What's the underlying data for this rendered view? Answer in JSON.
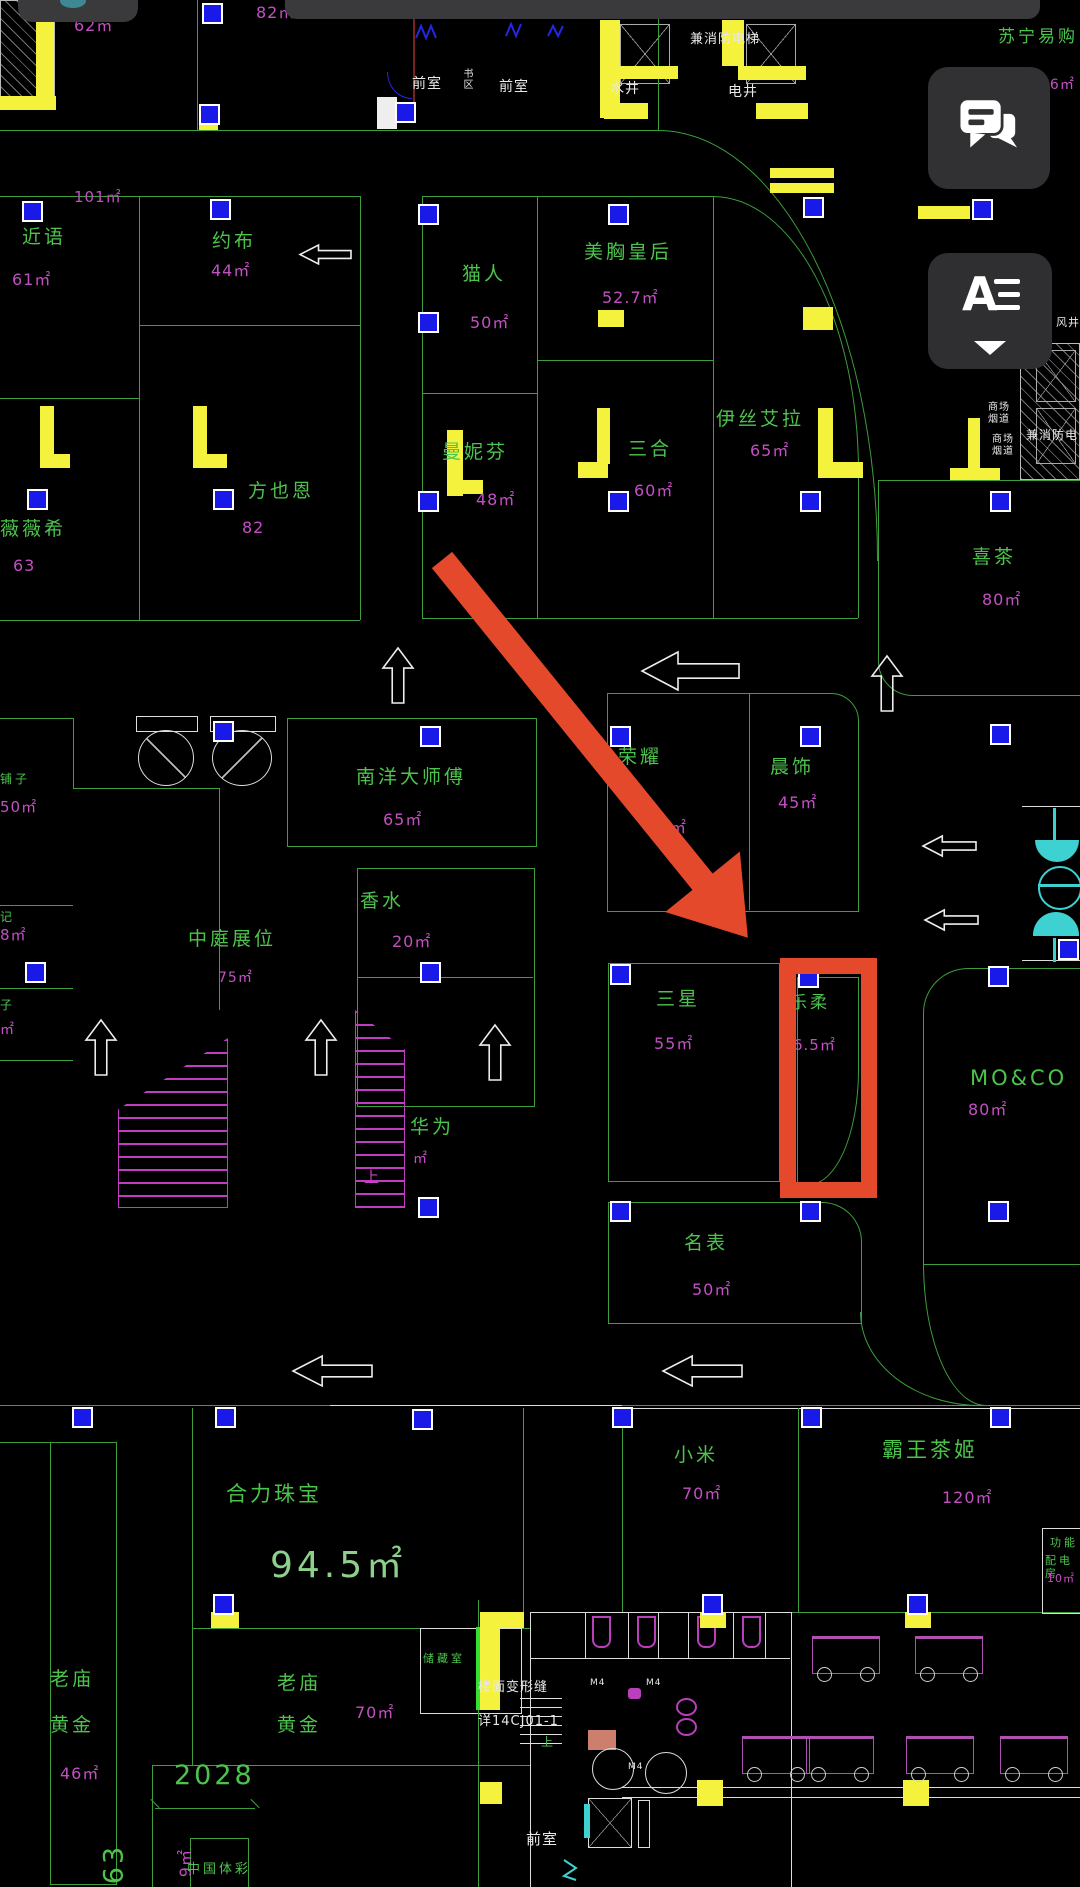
{
  "ui": {
    "statusbar": {
      "camera_color": "#3E8894"
    },
    "chat_button": {
      "icon": "chat-bubbles-icon"
    },
    "layer_button": {
      "label": "A",
      "icon": "text-layers-icon",
      "caret": "caret-down"
    }
  },
  "annotation": {
    "color": "#E5492B",
    "arrow": {
      "x": 442,
      "y": 560,
      "length": 486,
      "angle_deg": 51,
      "shaft_px": 26,
      "head_len": 72,
      "head_w": 96
    },
    "highlight_rect": {
      "x": 780,
      "y": 958,
      "w": 97,
      "h": 240,
      "border_px": 16
    }
  },
  "palette": {
    "line_green": "#3C9F3C",
    "text_green": "#4CC44C",
    "area_magenta": "#C250C2",
    "big_green": "#8CD08C",
    "white": "#E8E8E8",
    "yellow": "#F5F23D",
    "marker_blue": "#1A1AE8",
    "cyan": "#3ED1D1",
    "red": "#E5492B",
    "panel": "#313134"
  },
  "plan": {
    "labels": [
      {
        "n": "area-62",
        "t": "62㎡",
        "x": 74,
        "y": 16,
        "c": "area"
      },
      {
        "n": "area-82",
        "t": "82㎡",
        "x": 256,
        "y": 3,
        "c": "area"
      },
      {
        "n": "room-front-1",
        "t": "前室",
        "x": 412,
        "y": 76,
        "c": "white"
      },
      {
        "n": "room-shuqu",
        "t": "书区",
        "x": 460,
        "y": 68,
        "c": "white",
        "s": 10,
        "v": 1
      },
      {
        "n": "room-front-2",
        "t": "前室",
        "x": 499,
        "y": 79,
        "c": "white"
      },
      {
        "n": "room-water-shaft",
        "t": "水井",
        "x": 610,
        "y": 81,
        "c": "white"
      },
      {
        "n": "note-fire-elevator-top",
        "t": "兼消防电梯",
        "x": 690,
        "y": 32,
        "c": "white",
        "s": 13
      },
      {
        "n": "room-elec-shaft",
        "t": "电井",
        "x": 728,
        "y": 84,
        "c": "white"
      },
      {
        "n": "store-suning",
        "t": "苏宁易购",
        "x": 998,
        "y": 27,
        "c": "store",
        "s": 17
      },
      {
        "n": "area-suning",
        "t": "26㎡",
        "x": 1040,
        "y": 77,
        "c": "area",
        "s": 14
      },
      {
        "n": "area-101",
        "t": "101㎡",
        "x": 74,
        "y": 188,
        "c": "area",
        "s": 15
      },
      {
        "n": "store-jinyu",
        "t": "近语",
        "x": 22,
        "y": 226,
        "c": "store"
      },
      {
        "n": "area-jinyu",
        "t": "61㎡",
        "x": 12,
        "y": 270,
        "c": "area"
      },
      {
        "n": "store-yuebu",
        "t": "约布",
        "x": 212,
        "y": 230,
        "c": "store"
      },
      {
        "n": "area-yuebu",
        "t": "44㎡",
        "x": 211,
        "y": 261,
        "c": "area"
      },
      {
        "n": "store-weiweixi",
        "t": "薇薇希",
        "x": 0,
        "y": 518,
        "c": "store"
      },
      {
        "n": "area-weiweixi",
        "t": "63",
        "x": 13,
        "y": 556,
        "c": "area"
      },
      {
        "n": "store-fangyeen",
        "t": "方也恩",
        "x": 248,
        "y": 480,
        "c": "store"
      },
      {
        "n": "area-fangyeen",
        "t": "82",
        "x": 242,
        "y": 518,
        "c": "area"
      },
      {
        "n": "store-maoren",
        "t": "猫人",
        "x": 462,
        "y": 263,
        "c": "store"
      },
      {
        "n": "area-maoren",
        "t": "50㎡",
        "x": 470,
        "y": 313,
        "c": "area"
      },
      {
        "n": "store-meixiong",
        "t": "美胸皇后",
        "x": 584,
        "y": 241,
        "c": "store"
      },
      {
        "n": "area-meixiong",
        "t": "52.7㎡",
        "x": 602,
        "y": 288,
        "c": "area"
      },
      {
        "n": "store-mannifen",
        "t": "曼妮芬",
        "x": 442,
        "y": 441,
        "c": "store"
      },
      {
        "n": "area-mannifen",
        "t": "48㎡",
        "x": 476,
        "y": 490,
        "c": "area"
      },
      {
        "n": "store-sanhe",
        "t": "三合",
        "x": 628,
        "y": 438,
        "c": "store"
      },
      {
        "n": "area-sanhe",
        "t": "60㎡",
        "x": 634,
        "y": 481,
        "c": "area"
      },
      {
        "n": "store-yisiaila",
        "t": "伊丝艾拉",
        "x": 716,
        "y": 408,
        "c": "store"
      },
      {
        "n": "area-yisiaila",
        "t": "65㎡",
        "x": 750,
        "y": 441,
        "c": "area"
      },
      {
        "n": "store-xicha",
        "t": "喜茶",
        "x": 972,
        "y": 546,
        "c": "store"
      },
      {
        "n": "area-xicha",
        "t": "80㎡",
        "x": 982,
        "y": 590,
        "c": "area"
      },
      {
        "n": "room-fengjing",
        "t": "风井",
        "x": 1056,
        "y": 316,
        "c": "white",
        "s": 11
      },
      {
        "n": "note-flue-1",
        "t": "商场\n烟道",
        "x": 988,
        "y": 402,
        "c": "white",
        "s": 10
      },
      {
        "n": "note-flue-2",
        "t": "商场\n烟道",
        "x": 992,
        "y": 434,
        "c": "white",
        "s": 10
      },
      {
        "n": "note-fire-elevator-right",
        "t": "兼消防电",
        "x": 1026,
        "y": 428,
        "c": "white",
        "s": 12
      },
      {
        "n": "store-nanyang",
        "t": "南洋大师傅",
        "x": 356,
        "y": 766,
        "c": "store"
      },
      {
        "n": "area-nanyang",
        "t": "65㎡",
        "x": 383,
        "y": 810,
        "c": "area"
      },
      {
        "n": "store-xiangshui",
        "t": "香水",
        "x": 360,
        "y": 890,
        "c": "store"
      },
      {
        "n": "area-xiangshui",
        "t": "20㎡",
        "x": 392,
        "y": 932,
        "c": "area"
      },
      {
        "n": "store-zhongting",
        "t": "中庭展位",
        "x": 188,
        "y": 928,
        "c": "store"
      },
      {
        "n": "area-zhongting",
        "t": "75㎡",
        "x": 218,
        "y": 970,
        "c": "area",
        "s": 14
      },
      {
        "n": "store-rongyao",
        "t": "荣耀",
        "x": 618,
        "y": 746,
        "c": "store"
      },
      {
        "n": "area-rongyao",
        "t": "㎡",
        "x": 670,
        "y": 818,
        "c": "area"
      },
      {
        "n": "store-chenshi",
        "t": "晨饰",
        "x": 770,
        "y": 756,
        "c": "store"
      },
      {
        "n": "area-chenshi",
        "t": "45㎡",
        "x": 778,
        "y": 793,
        "c": "area"
      },
      {
        "n": "store-huawei",
        "t": "华为",
        "x": 410,
        "y": 1116,
        "c": "store"
      },
      {
        "n": "area-huawei",
        "t": "㎡",
        "x": 413,
        "y": 1151,
        "c": "area",
        "s": 14
      },
      {
        "n": "esc-up-label",
        "t": "上",
        "x": 364,
        "y": 1168,
        "c": "mag"
      },
      {
        "n": "store-puzi-1",
        "t": "铺子",
        "x": 0,
        "y": 772,
        "c": "store",
        "s": 12
      },
      {
        "n": "area-puzi-1",
        "t": "50㎡",
        "x": 0,
        "y": 798,
        "c": "area",
        "s": 15
      },
      {
        "n": "store-ji",
        "t": "记",
        "x": 0,
        "y": 910,
        "c": "store",
        "s": 12
      },
      {
        "n": "area-ji",
        "t": "8㎡",
        "x": 0,
        "y": 926,
        "c": "area",
        "s": 15
      },
      {
        "n": "store-zi",
        "t": "子",
        "x": 0,
        "y": 998,
        "c": "store",
        "s": 12
      },
      {
        "n": "area-zi",
        "t": "㎡",
        "x": 0,
        "y": 1022,
        "c": "area",
        "s": 14
      },
      {
        "n": "store-sanxing",
        "t": "三星",
        "x": 656,
        "y": 988,
        "c": "store"
      },
      {
        "n": "area-sanxing",
        "t": "55㎡",
        "x": 654,
        "y": 1034,
        "c": "area"
      },
      {
        "n": "store-lerou",
        "t": "乐柔",
        "x": 790,
        "y": 993,
        "c": "store",
        "s": 17
      },
      {
        "n": "area-lerou",
        "t": "6.5㎡",
        "x": 793,
        "y": 1036,
        "c": "area",
        "s": 15
      },
      {
        "n": "store-moco",
        "t": "MO&CO",
        "x": 970,
        "y": 1066,
        "c": "store",
        "s": 21
      },
      {
        "n": "area-moco",
        "t": "80㎡",
        "x": 968,
        "y": 1100,
        "c": "area"
      },
      {
        "n": "store-mingbiao",
        "t": "名表",
        "x": 684,
        "y": 1232,
        "c": "store"
      },
      {
        "n": "area-mingbiao",
        "t": "50㎡",
        "x": 692,
        "y": 1280,
        "c": "area"
      },
      {
        "n": "store-helizhubao",
        "t": "合力珠宝",
        "x": 226,
        "y": 1482,
        "c": "store",
        "s": 21
      },
      {
        "n": "area-helizhubao",
        "t": "94.5㎡",
        "x": 270,
        "y": 1544,
        "c": "big"
      },
      {
        "n": "store-laomiao1a",
        "t": "老庙",
        "x": 50,
        "y": 1668,
        "c": "store"
      },
      {
        "n": "store-laomiao1b",
        "t": "黄金",
        "x": 50,
        "y": 1714,
        "c": "store"
      },
      {
        "n": "area-laomiao1",
        "t": "46㎡",
        "x": 60,
        "y": 1764,
        "c": "area"
      },
      {
        "n": "store-laomiao2a",
        "t": "老庙",
        "x": 277,
        "y": 1672,
        "c": "store"
      },
      {
        "n": "store-laomiao2b",
        "t": "黄金",
        "x": 277,
        "y": 1714,
        "c": "store"
      },
      {
        "n": "area-laomiao2",
        "t": "70㎡",
        "x": 355,
        "y": 1703,
        "c": "area"
      },
      {
        "n": "room-cangchushi",
        "t": "储藏室",
        "x": 423,
        "y": 1652,
        "c": "store",
        "s": 11
      },
      {
        "n": "store-xiaomi",
        "t": "小米",
        "x": 674,
        "y": 1444,
        "c": "store"
      },
      {
        "n": "area-xiaomi",
        "t": "70㎡",
        "x": 682,
        "y": 1484,
        "c": "area"
      },
      {
        "n": "store-bawangchaji",
        "t": "霸王茶姬",
        "x": 882,
        "y": 1438,
        "c": "store",
        "s": 21
      },
      {
        "n": "area-bawangchaji",
        "t": "120㎡",
        "x": 942,
        "y": 1488,
        "c": "area"
      },
      {
        "n": "room-gongneng",
        "t": "功能",
        "x": 1050,
        "y": 1536,
        "c": "store",
        "s": 11
      },
      {
        "n": "room-peidianfang",
        "t": "配电房",
        "x": 1045,
        "y": 1554,
        "c": "store",
        "s": 11
      },
      {
        "n": "area-peidianfang",
        "t": "10㎡",
        "x": 1047,
        "y": 1572,
        "c": "area",
        "s": 11
      },
      {
        "n": "dim-2028",
        "t": "2028",
        "x": 174,
        "y": 1760,
        "c": "store",
        "s": 27
      },
      {
        "n": "dim-463",
        "t": "463",
        "x": 131,
        "y": 1872,
        "c": "store",
        "s": 27,
        "r": -90
      },
      {
        "n": "area-ticai",
        "t": "9㎡",
        "x": 195,
        "y": 1858,
        "c": "area",
        "s": 16,
        "r": -90
      },
      {
        "n": "store-ticai",
        "t": "中国体彩",
        "x": 187,
        "y": 1862,
        "c": "store",
        "s": 13
      },
      {
        "n": "note-deformation",
        "t": "楼面变形缝",
        "x": 478,
        "y": 1680,
        "c": "white",
        "s": 13
      },
      {
        "n": "note-detail-ref",
        "t": "详14CJ01-1",
        "x": 478,
        "y": 1714,
        "c": "white",
        "s": 13
      },
      {
        "n": "room-front-3",
        "t": "前室",
        "x": 526,
        "y": 1830,
        "c": "white",
        "s": 15
      },
      {
        "n": "stairs-up-label",
        "t": "上",
        "x": 541,
        "y": 1735,
        "c": "store",
        "s": 12
      },
      {
        "n": "door-m4-1",
        "t": "M4",
        "x": 590,
        "y": 1678,
        "c": "white",
        "s": 9
      },
      {
        "n": "door-m4-2",
        "t": "M4",
        "x": 646,
        "y": 1678,
        "c": "white",
        "s": 9
      },
      {
        "n": "door-m4-3",
        "t": "M4",
        "x": 628,
        "y": 1762,
        "c": "white",
        "s": 9
      }
    ],
    "blue_markers": [
      [
        202,
        3
      ],
      [
        395,
        102
      ],
      [
        199,
        104
      ],
      [
        22,
        201
      ],
      [
        210,
        199
      ],
      [
        418,
        204
      ],
      [
        608,
        204
      ],
      [
        803,
        197
      ],
      [
        418,
        312
      ],
      [
        27,
        489
      ],
      [
        213,
        489
      ],
      [
        418,
        491
      ],
      [
        608,
        491
      ],
      [
        800,
        491
      ],
      [
        990,
        491
      ],
      [
        972,
        199
      ],
      [
        213,
        721
      ],
      [
        420,
        726
      ],
      [
        610,
        726
      ],
      [
        800,
        726
      ],
      [
        990,
        724
      ],
      [
        1058,
        939
      ],
      [
        25,
        962
      ],
      [
        420,
        962
      ],
      [
        610,
        964
      ],
      [
        988,
        966
      ],
      [
        798,
        967
      ],
      [
        418,
        1197
      ],
      [
        610,
        1201
      ],
      [
        800,
        1201
      ],
      [
        988,
        1201
      ],
      [
        72,
        1407
      ],
      [
        215,
        1407
      ],
      [
        412,
        1409
      ],
      [
        612,
        1407
      ],
      [
        801,
        1407
      ],
      [
        990,
        1407
      ],
      [
        213,
        1594
      ],
      [
        702,
        1594
      ],
      [
        907,
        1594
      ]
    ],
    "yellow_rects": [
      [
        36,
        6,
        18,
        94
      ],
      [
        0,
        96,
        56,
        14
      ],
      [
        600,
        20,
        20,
        98
      ],
      [
        600,
        66,
        78,
        13
      ],
      [
        604,
        103,
        44,
        16
      ],
      [
        722,
        20,
        22,
        46
      ],
      [
        738,
        66,
        68,
        14
      ],
      [
        756,
        103,
        52,
        16
      ],
      [
        770,
        168,
        64,
        10
      ],
      [
        770,
        183,
        64,
        10
      ],
      [
        918,
        206,
        52,
        13
      ],
      [
        40,
        406,
        14,
        62
      ],
      [
        40,
        454,
        30,
        14
      ],
      [
        193,
        406,
        14,
        62
      ],
      [
        193,
        454,
        34,
        14
      ],
      [
        447,
        430,
        16,
        66
      ],
      [
        447,
        480,
        36,
        14
      ],
      [
        597,
        408,
        13,
        56
      ],
      [
        578,
        462,
        30,
        16
      ],
      [
        818,
        408,
        15,
        70
      ],
      [
        818,
        462,
        45,
        16
      ],
      [
        598,
        310,
        26,
        17
      ],
      [
        803,
        307,
        30,
        23
      ],
      [
        968,
        418,
        12,
        60
      ],
      [
        950,
        468,
        50,
        12
      ],
      [
        211,
        1612,
        28,
        16
      ],
      [
        700,
        1612,
        26,
        16
      ],
      [
        905,
        1612,
        26,
        16
      ],
      [
        697,
        1780,
        26,
        26
      ],
      [
        903,
        1780,
        26,
        26
      ],
      [
        480,
        1612,
        44,
        16
      ],
      [
        480,
        1612,
        20,
        98
      ],
      [
        480,
        1782,
        22,
        22
      ],
      [
        199,
        124,
        19,
        6
      ]
    ],
    "desks": [
      [
        812,
        1636
      ],
      [
        915,
        1636
      ],
      [
        742,
        1736
      ],
      [
        806,
        1736
      ],
      [
        906,
        1736
      ],
      [
        1000,
        1736
      ]
    ],
    "arrows": [
      {
        "d": "left",
        "x": 298,
        "y": 243,
        "w": 54
      },
      {
        "d": "left",
        "x": 640,
        "y": 650,
        "w": 100
      },
      {
        "d": "up",
        "x": 381,
        "y": 646
      },
      {
        "d": "up",
        "x": 870,
        "y": 654
      },
      {
        "d": "left",
        "x": 921,
        "y": 834,
        "w": 56
      },
      {
        "d": "left",
        "x": 923,
        "y": 908,
        "w": 56
      },
      {
        "d": "up",
        "x": 84,
        "y": 1018
      },
      {
        "d": "up",
        "x": 304,
        "y": 1018
      },
      {
        "d": "up",
        "x": 478,
        "y": 1023
      },
      {
        "d": "left",
        "x": 291,
        "y": 1354,
        "w": 82
      },
      {
        "d": "left",
        "x": 661,
        "y": 1354,
        "w": 82
      }
    ]
  }
}
